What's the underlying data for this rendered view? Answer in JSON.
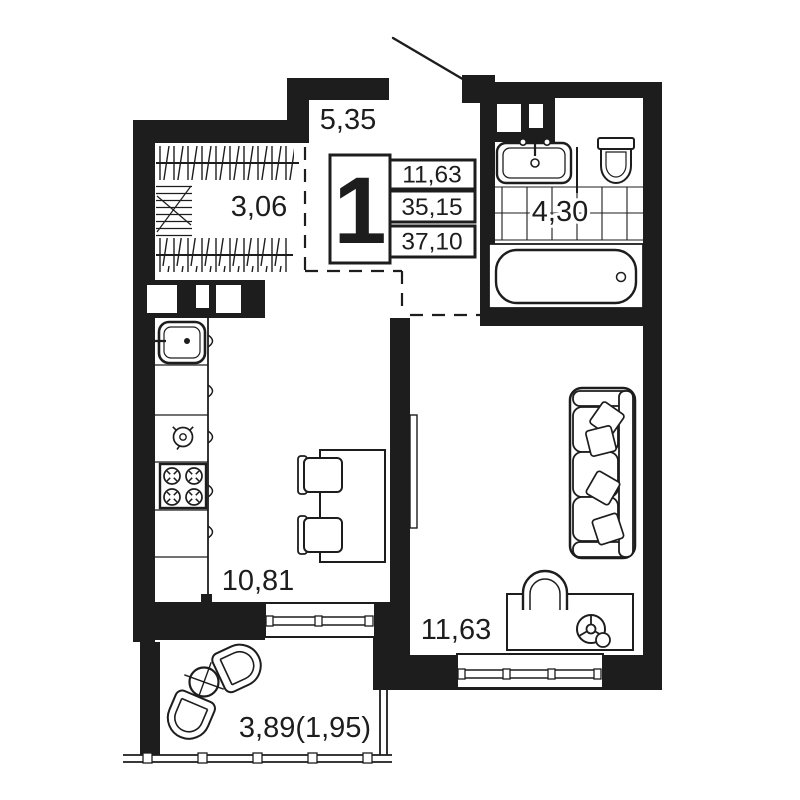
{
  "plan": {
    "colors": {
      "wall": "#1d1d1d",
      "background": "#ffffff"
    },
    "legend": {
      "rooms_count": "1",
      "areas": [
        "11,63",
        "35,15",
        "37,10"
      ]
    },
    "rooms": {
      "hallway": {
        "area": "5,35"
      },
      "wardrobe": {
        "area": "3,06"
      },
      "bathroom": {
        "area": "4,30"
      },
      "kitchen": {
        "area": "10,81"
      },
      "living_room": {
        "area": "11,63"
      },
      "balcony": {
        "area": "3,89(1,95)"
      }
    }
  }
}
